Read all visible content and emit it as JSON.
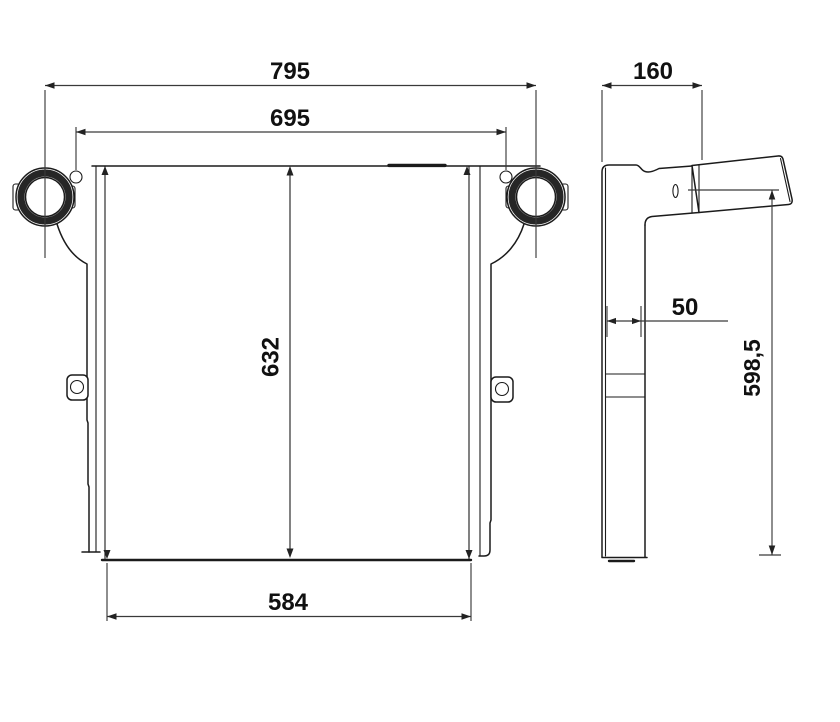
{
  "drawing": {
    "background": "#ffffff",
    "line_color": "#1b1b1b",
    "dim_color": "#3a3a3a",
    "front_view": {
      "width_overall": "795",
      "width_inner": "695",
      "height_core": "632",
      "width_bottom": "584"
    },
    "side_view": {
      "depth_top": "160",
      "depth_lower": "50",
      "height_overall": "598,5"
    }
  }
}
